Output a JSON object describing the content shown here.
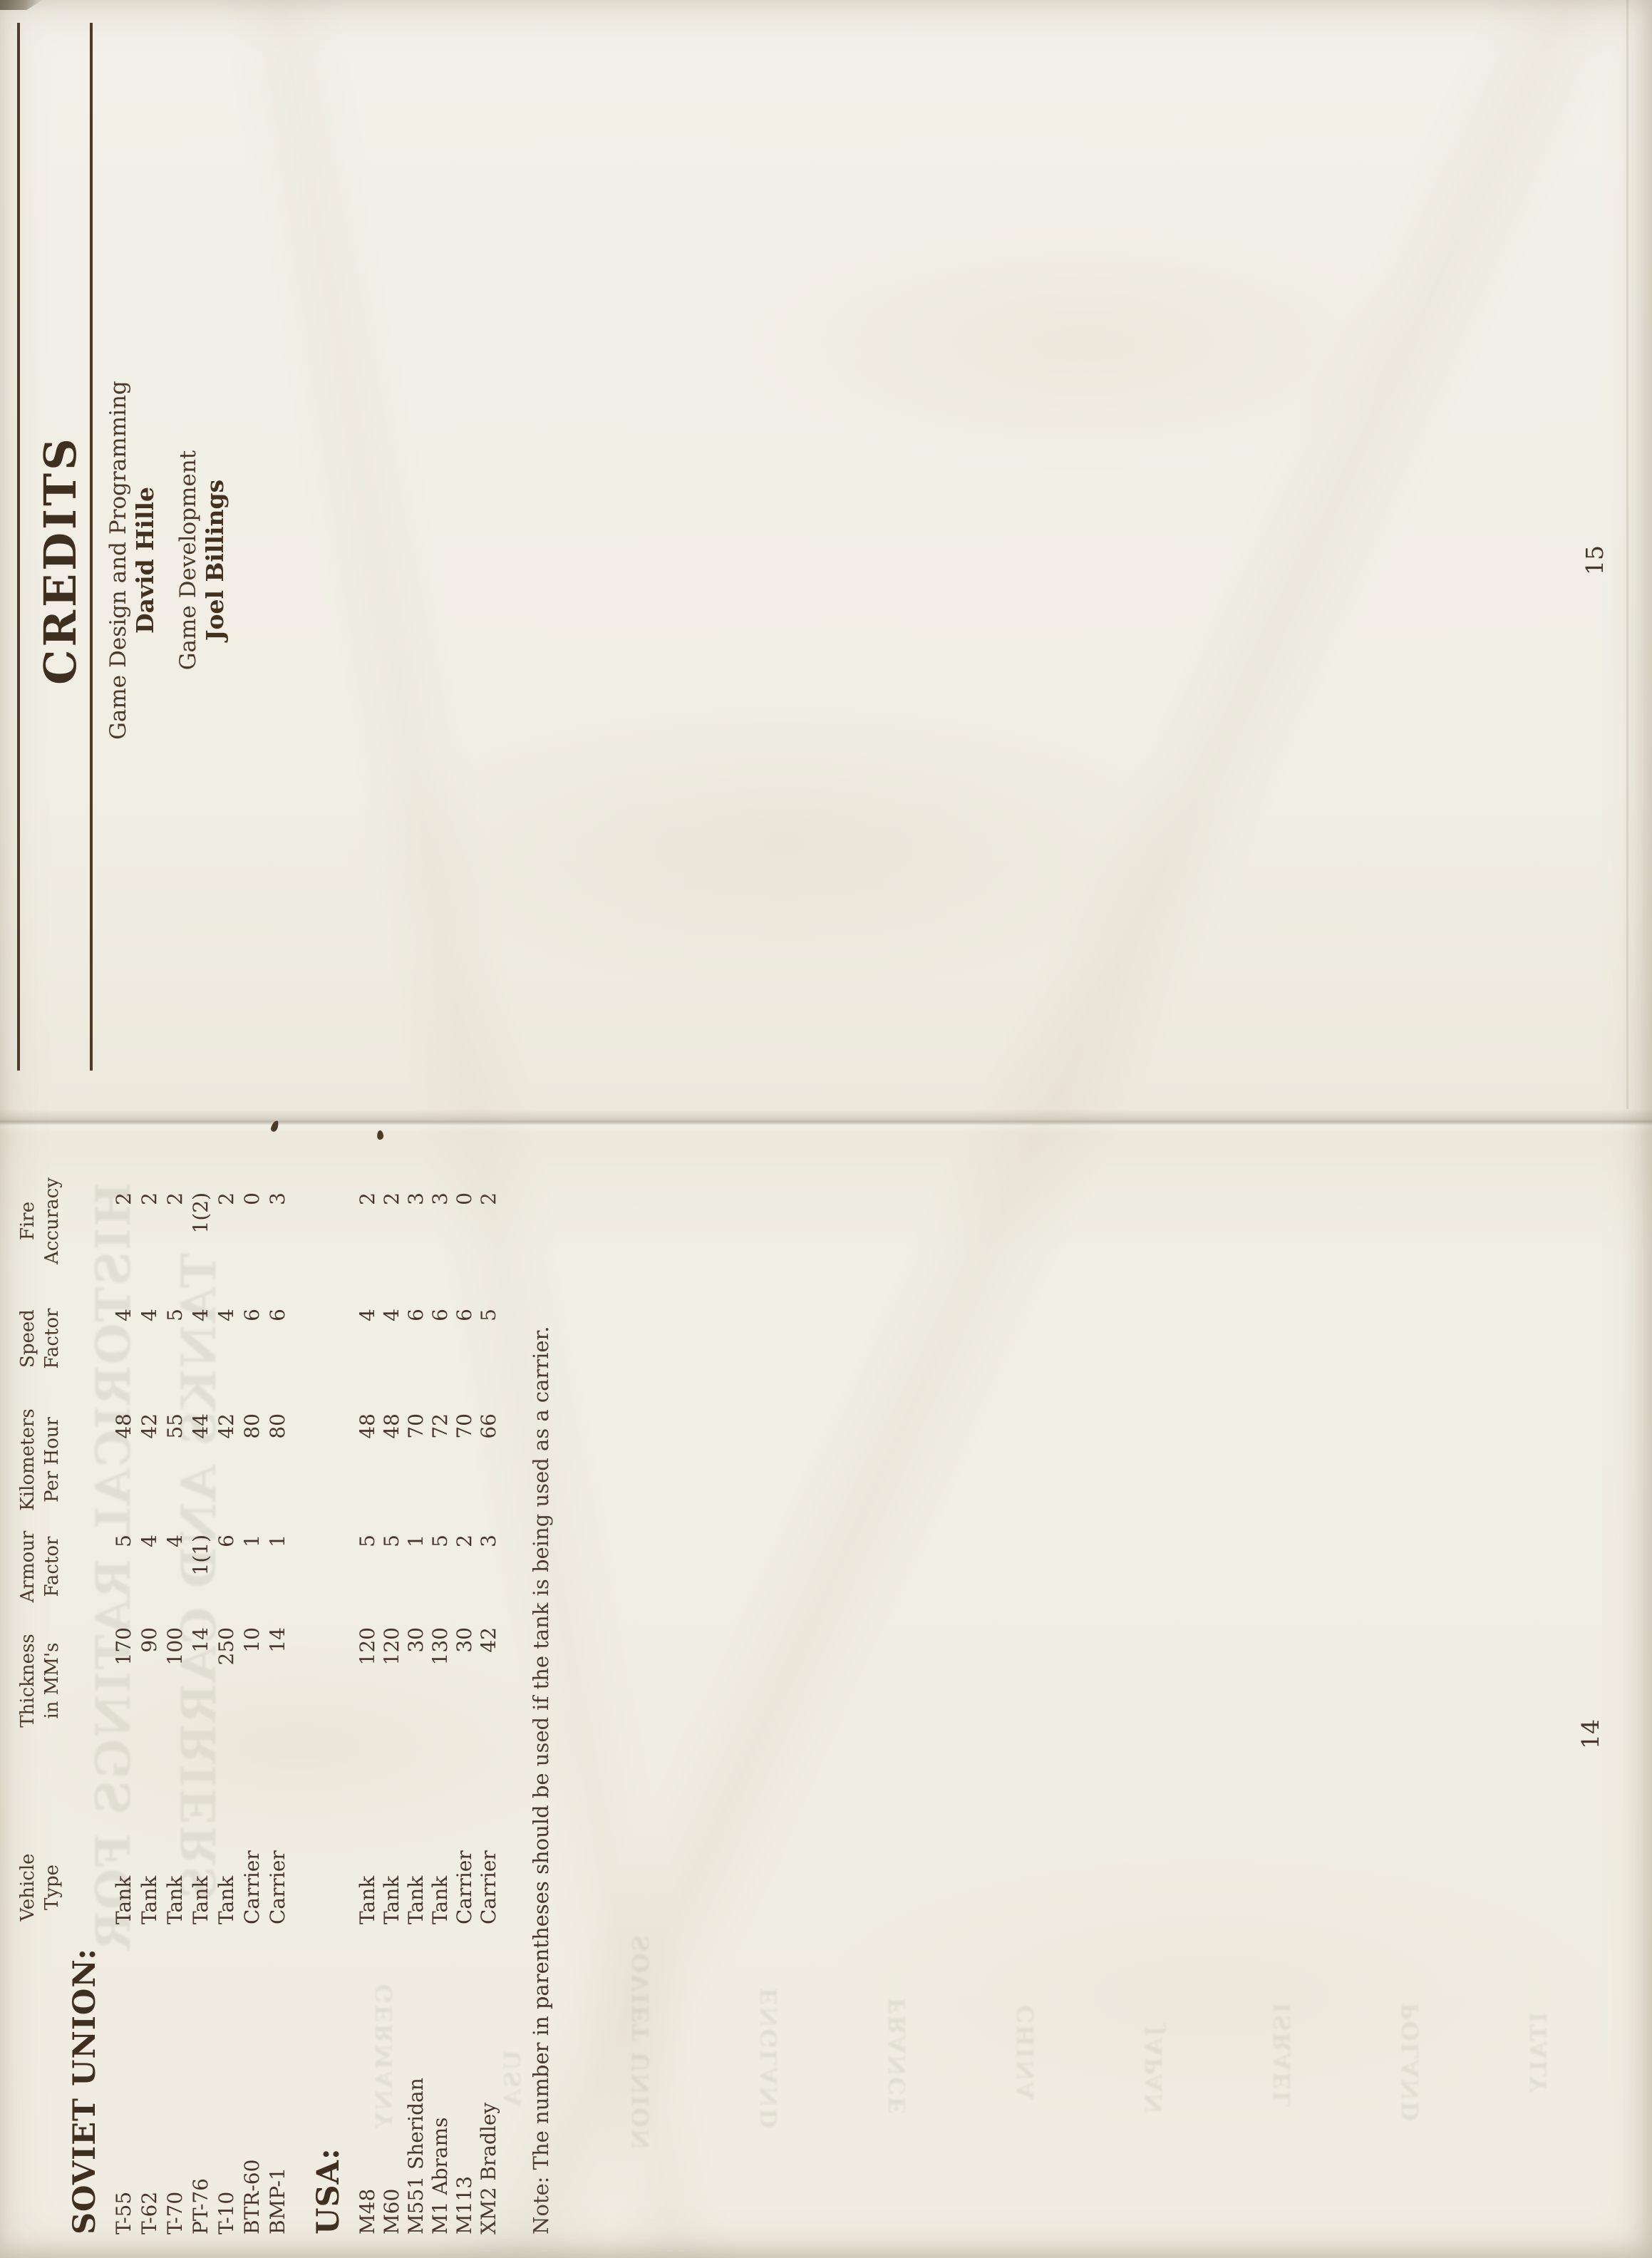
{
  "page15": {
    "title": "CREDITS",
    "credits": [
      {
        "role": "Game Design and Programming",
        "name": "David Hille"
      },
      {
        "role": "Game Development",
        "name": "Joel Billings"
      }
    ],
    "page_number": "15"
  },
  "page14": {
    "headers": [
      {
        "line1": "Vehicle",
        "line2": "Type"
      },
      {
        "line1": "Thickness",
        "line2": "in MM's"
      },
      {
        "line1": "Armour",
        "line2": "Factor"
      },
      {
        "line1": "Kilometers",
        "line2": "Per Hour"
      },
      {
        "line1": "Speed",
        "line2": "Factor"
      },
      {
        "line1": "Fire",
        "line2": "Accuracy"
      }
    ],
    "sections": [
      {
        "label": "SOVIET UNION:",
        "rows": [
          {
            "name": "T-55",
            "type": "Tank",
            "thickness": "170",
            "armour": "5",
            "kph": "48",
            "speed": "4",
            "fire": "2"
          },
          {
            "name": "T-62",
            "type": "Tank",
            "thickness": "90",
            "armour": "4",
            "kph": "42",
            "speed": "4",
            "fire": "2"
          },
          {
            "name": "T-70",
            "type": "Tank",
            "thickness": "100",
            "armour": "4",
            "kph": "55",
            "speed": "5",
            "fire": "2"
          },
          {
            "name": "PT-76",
            "type": "Tank",
            "thickness": "14",
            "armour": "1(1)",
            "kph": "44",
            "speed": "4",
            "fire": "1(2)"
          },
          {
            "name": "T-10",
            "type": "Tank",
            "thickness": "250",
            "armour": "6",
            "kph": "42",
            "speed": "4",
            "fire": "2"
          },
          {
            "name": "BTR-60",
            "type": "Carrier",
            "thickness": "10",
            "armour": "1",
            "kph": "80",
            "speed": "6",
            "fire": "0"
          },
          {
            "name": "BMP-1",
            "type": "Carrier",
            "thickness": "14",
            "armour": "1",
            "kph": "80",
            "speed": "6",
            "fire": "3"
          }
        ]
      },
      {
        "label": "USA:",
        "rows": [
          {
            "name": "M48",
            "type": "Tank",
            "thickness": "120",
            "armour": "5",
            "kph": "48",
            "speed": "4",
            "fire": "2"
          },
          {
            "name": "M60",
            "type": "Tank",
            "thickness": "120",
            "armour": "5",
            "kph": "48",
            "speed": "4",
            "fire": "2"
          },
          {
            "name": "M551 Sheridan",
            "type": "Tank",
            "thickness": "30",
            "armour": "1",
            "kph": "70",
            "speed": "6",
            "fire": "3"
          },
          {
            "name": "M1 Abrams",
            "type": "Tank",
            "thickness": "130",
            "armour": "5",
            "kph": "72",
            "speed": "6",
            "fire": "3"
          },
          {
            "name": "M113",
            "type": "Carrier",
            "thickness": "30",
            "armour": "2",
            "kph": "70",
            "speed": "6",
            "fire": "0"
          },
          {
            "name": "XM2 Bradley",
            "type": "Carrier",
            "thickness": "42",
            "armour": "3",
            "kph": "66",
            "speed": "5",
            "fire": "2"
          }
        ]
      }
    ],
    "note": "Note: The number in parentheses should be used if the tank is being used as a carrier.",
    "page_number": "14"
  },
  "bleedthrough": {
    "items": [
      "HISTORICAL RATINGS FOR",
      "TANKS AND CARRIERS",
      "GERMANY",
      "USA",
      "SOVIET UNION",
      "ENGLAND",
      "FRANCE",
      "CHINA",
      "JAPAN",
      "ISRAEL",
      "POLAND",
      "ITALY"
    ]
  },
  "colors": {
    "paper": "#f1eee4",
    "ink": "#443326",
    "rule": "#4a3a2b",
    "seam_shadow": "#d8d3c5"
  }
}
